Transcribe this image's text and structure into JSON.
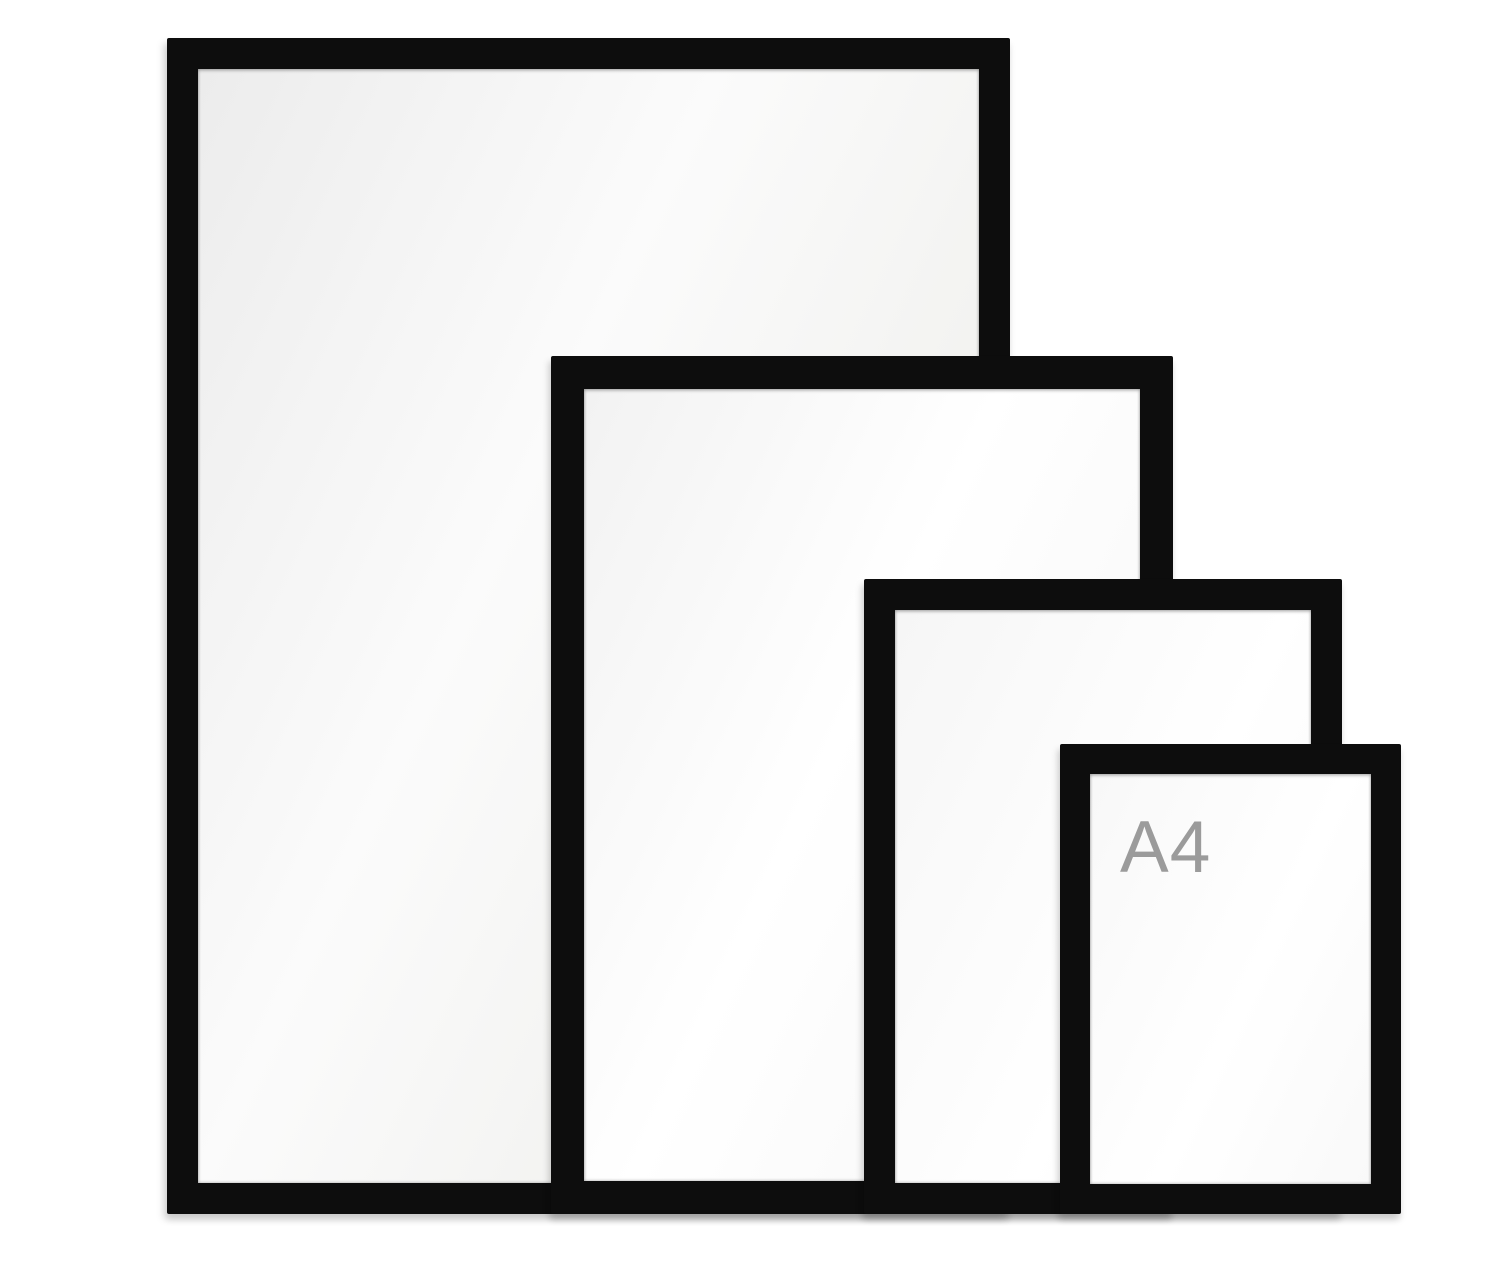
{
  "scene": {
    "background_color": "#ffffff",
    "frame_color": "#0d0d0d",
    "opening_color": "#f4f4f4",
    "label_color": "#9b9b9b",
    "frames": [
      {
        "rank": "largest",
        "label": ""
      },
      {
        "rank": "second-largest",
        "label": ""
      },
      {
        "rank": "third-largest",
        "label": ""
      },
      {
        "rank": "smallest",
        "label": "A4"
      }
    ]
  }
}
